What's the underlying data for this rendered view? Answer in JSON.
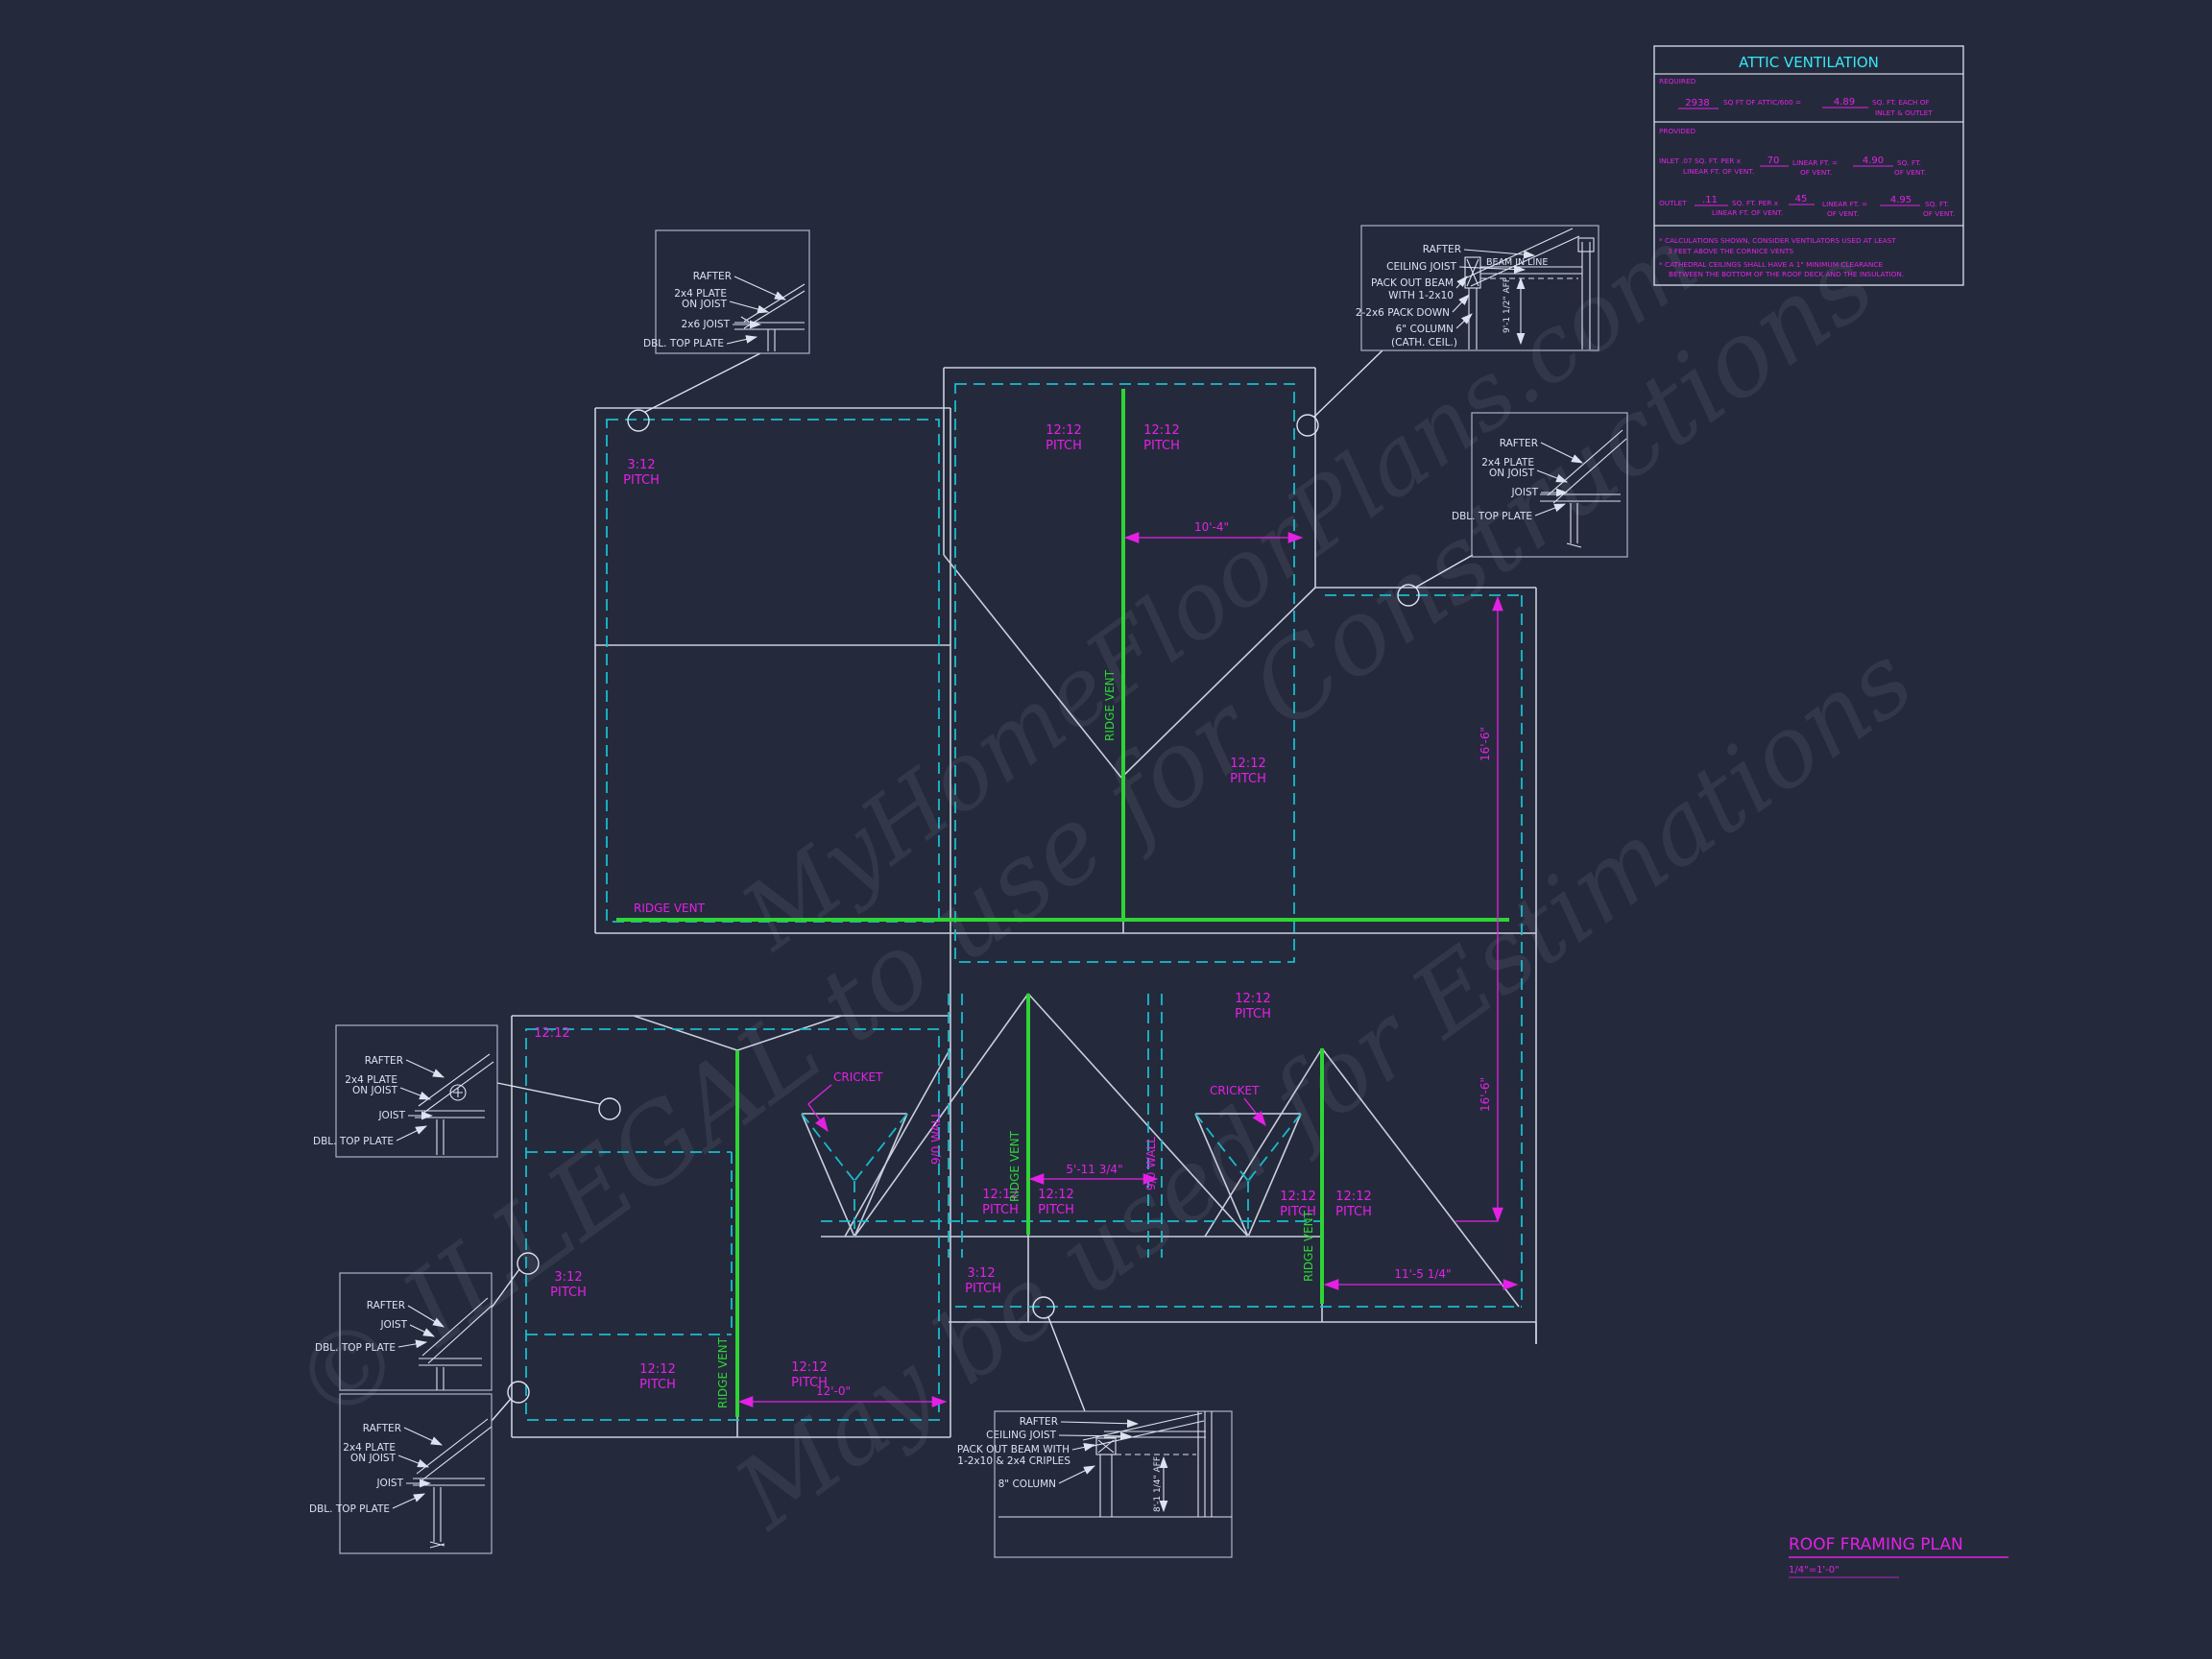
{
  "watermark": {
    "l1": "MyHomeFloorPlans.com",
    "l2": "© ILLEGAL to use for Constructions",
    "l3": "May be used for Estimations"
  },
  "title_block": {
    "title": "ROOF FRAMING PLAN",
    "scale": "1/4\"=1'-0\""
  },
  "attic_table": {
    "title": "ATTIC VENTILATION",
    "required_label": "REQUIRED",
    "required_value": "2938",
    "required_mid": "SQ FT OF ATTIC/600 =",
    "required_result": "4.89",
    "required_suffix1": "SQ. FT. EACH OF",
    "required_suffix2": "INLET & OUTLET",
    "provided_label": "PROVIDED",
    "inlet_prefix": "INLET .07 SQ. FT. PER x",
    "inlet_prefix2": "LINEAR FT. OF VENT.",
    "inlet_len": "70",
    "inlet_mid1": "LINEAR FT. =",
    "inlet_mid2": "OF VENT.",
    "inlet_result": "4.90",
    "inlet_suffix1": "SQ. FT.",
    "inlet_suffix2": "OF VENT.",
    "outlet_label": "OUTLET",
    "outlet_rate": ".11",
    "outlet_rate_suffix1": "SQ. FT. PER x",
    "outlet_rate_suffix2": "LINEAR FT. OF VENT.",
    "outlet_len": "45",
    "outlet_mid1": "LINEAR FT. =",
    "outlet_mid2": "OF VENT.",
    "outlet_result": "4.95",
    "outlet_suffix1": "SQ. FT.",
    "outlet_suffix2": "OF VENT.",
    "note1a": "* CALCULATIONS SHOWN, CONSIDER VENTILATORS USED AT LEAST",
    "note1b": "3 FEET ABOVE THE CORNICE VENTS",
    "note2a": "* CATHEDRAL CEILINGS SHALL HAVE A 1\" MINIMUM CLEARANCE",
    "note2b": "BETWEEN THE BOTTOM OF THE ROOF DECK AND THE INSULATION."
  },
  "plan": {
    "pitch_12": "12:12",
    "pitch_3": "3:12",
    "pitch_word": "PITCH",
    "ridge_vent": "RIDGE VENT",
    "cricket": "CRICKET",
    "wall_9_0": "9/0 WALL",
    "dim_10_4": "10'-4\"",
    "dim_16_6": "16'-6\"",
    "dim_5_11": "5'-11 3/4\"",
    "dim_11_5": "11'-5 1/4\"",
    "dim_12_0": "12'-0\""
  },
  "details": {
    "rafter": "RAFTER",
    "plate_2x4": "2x4 PLATE",
    "on_joist": "ON JOIST",
    "joist_2x6": "2x6 JOIST",
    "joist": "JOIST",
    "ceiling_joist": "CEILING JOIST",
    "dbl_top_plate": "DBL. TOP PLATE",
    "pack_out_beam1": "PACK OUT BEAM",
    "pack_out_beam2": "WITH 1-2x10",
    "pack_down": "2-2x6 PACK DOWN",
    "column_6": "6\" COLUMN",
    "cath_ceil": "(CATH. CEIL.)",
    "beam_in_line": "BEAM IN LINE",
    "aff_9_1": "9'-1 1/2\" AFF",
    "pack_out_beam_b1": "PACK OUT BEAM WITH",
    "pack_out_beam_b2": "1-2x10 & 2x4 CRIPLES",
    "column_8": "8\" COLUMN",
    "aff_8_1": "8'-1 1/4\" AFF"
  }
}
